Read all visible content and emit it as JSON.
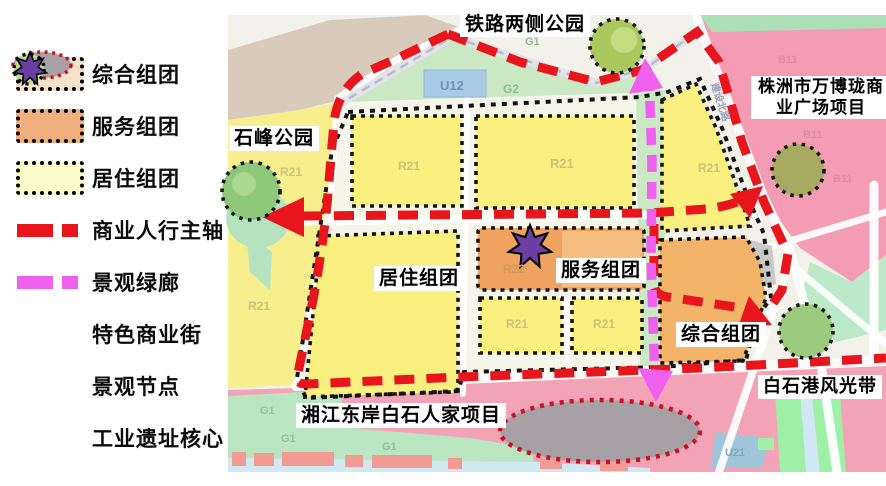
{
  "legend": {
    "items": [
      {
        "label": "综合组团",
        "type": "swatch",
        "color": "#f4e2cb"
      },
      {
        "label": "服务组团",
        "type": "swatch",
        "color": "#f2af7e"
      },
      {
        "label": "居住组团",
        "type": "swatch",
        "color": "#fbfbc9"
      },
      {
        "label": "商业人行主轴",
        "type": "dash",
        "color": "#e8151c"
      },
      {
        "label": "景观绿廊",
        "type": "dash",
        "color": "#f060ee"
      },
      {
        "label": "特色商业街",
        "type": "ellipse",
        "color": "#a7a1a5"
      },
      {
        "label": "景观节点",
        "type": "circle",
        "color": "#b8db8c"
      },
      {
        "label": "工业遗址核心",
        "type": "star",
        "color": "#6b3fa3"
      }
    ]
  },
  "map": {
    "labels": {
      "railway_park": "铁路两侧公园",
      "shifeng_park": "石峰公园",
      "wanbolong_line1": "株洲市万博珑商",
      "wanbolong_line2": "业广场项目",
      "residential": "居住组团",
      "service": "服务组团",
      "comprehensive": "综合组团",
      "baishigang": "白石港风光带",
      "xiangjiang": "湘江东岸白石人家项目"
    },
    "zone_labels": [
      {
        "text": "U12",
        "x": 440,
        "y": 90,
        "color": "#6f95bf",
        "size": 13
      },
      {
        "text": "G1",
        "x": 525,
        "y": 45,
        "color": "#8fbf8f",
        "size": 11
      },
      {
        "text": "G2",
        "x": 503,
        "y": 93,
        "color": "#8fbf8f",
        "size": 12
      },
      {
        "text": "R21",
        "x": 280,
        "y": 176,
        "color": "#cfc179",
        "size": 12
      },
      {
        "text": "R21",
        "x": 398,
        "y": 170,
        "color": "#cfc179",
        "size": 12
      },
      {
        "text": "R21",
        "x": 550,
        "y": 168,
        "color": "#cfc179",
        "size": 13
      },
      {
        "text": "R21",
        "x": 698,
        "y": 172,
        "color": "#cfc179",
        "size": 12
      },
      {
        "text": "R21",
        "x": 248,
        "y": 310,
        "color": "#cfc179",
        "size": 12
      },
      {
        "text": "R22",
        "x": 503,
        "y": 273,
        "color": "#cf9a5e",
        "size": 12
      },
      {
        "text": "R21",
        "x": 506,
        "y": 328,
        "color": "#cfc179",
        "size": 12
      },
      {
        "text": "R21",
        "x": 593,
        "y": 328,
        "color": "#cfc179",
        "size": 12
      },
      {
        "text": "B11",
        "x": 778,
        "y": 63,
        "color": "#e08ca6",
        "size": 11
      },
      {
        "text": "B11",
        "x": 803,
        "y": 138,
        "color": "#e08ca6",
        "size": 11
      },
      {
        "text": "B11",
        "x": 833,
        "y": 182,
        "color": "#e08ca6",
        "size": 11
      },
      {
        "text": "U21",
        "x": 725,
        "y": 456,
        "color": "#7fa6b8",
        "size": 11
      },
      {
        "text": "G1",
        "x": 260,
        "y": 414,
        "color": "#8fc39a",
        "size": 11
      },
      {
        "text": "G1",
        "x": 281,
        "y": 442,
        "color": "#8fc39a",
        "size": 11
      },
      {
        "text": "G1",
        "x": 382,
        "y": 450,
        "color": "#8fc39a",
        "size": 11
      },
      {
        "text": "建设北路",
        "x": 711,
        "y": 84,
        "color": "#9aa0b8",
        "size": 10,
        "rot": 72
      }
    ]
  },
  "colors": {
    "main_axis_red": "#e8151c",
    "green_corridor_magenta": "#f060ee",
    "residential_yellow": "#f9f080",
    "service_orange": "#f0a261",
    "comprehensive_orange": "#f3b369",
    "node_green": "#b8db8c",
    "heritage_purple": "#6b3fa3",
    "street_gray": "#a7a1a5"
  }
}
